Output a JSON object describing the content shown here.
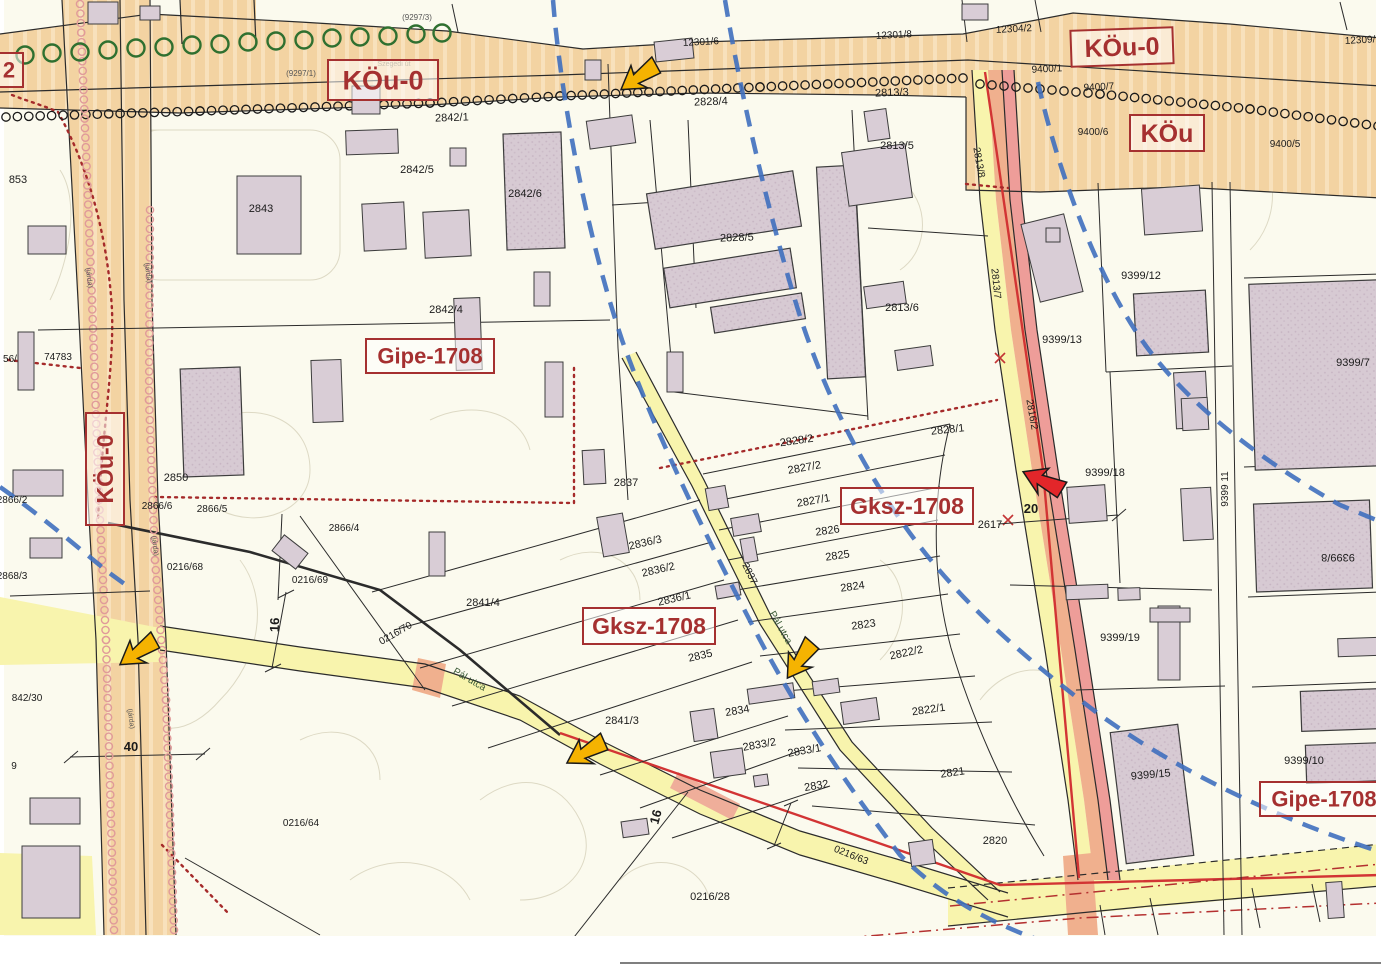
{
  "map": {
    "colors": {
      "zone_red": "#a53030",
      "road_orange": "#f3d3a2",
      "road_yellow": "#f8f4ad",
      "strip_salmon": "#f0b08e",
      "strip_pink": "#ee9d99",
      "blue_dash": "#3f6fbe",
      "arrow_yellow": "#F5B301",
      "arrow_red": "#E3262A",
      "building_fill": "#d9cdd6",
      "paper": "#fbfaee"
    },
    "zone_boxes": [
      {
        "t": "KÖu-0",
        "x": 383,
        "y": 80,
        "w": 110,
        "h": 40,
        "fs": 27
      },
      {
        "t": "KÖu-0",
        "x": 1122,
        "y": 47,
        "w": 102,
        "h": 36,
        "fs": 25,
        "rot": -2
      },
      {
        "t": "KÖu",
        "x": 1167,
        "y": 133,
        "w": 74,
        "h": 36,
        "fs": 25
      },
      {
        "t": "Gipe-1708",
        "x": 430,
        "y": 356,
        "w": 128,
        "h": 34,
        "fs": 22
      },
      {
        "t": "Gksz-1708",
        "x": 907,
        "y": 506,
        "w": 132,
        "h": 36,
        "fs": 23
      },
      {
        "t": "Gksz-1708",
        "x": 649,
        "y": 626,
        "w": 132,
        "h": 36,
        "fs": 23
      },
      {
        "t": "Gipe-1708",
        "x": 1324,
        "y": 799,
        "w": 128,
        "h": 34,
        "fs": 22
      },
      {
        "t": "KÖu-0",
        "x": 105,
        "y": 469,
        "w": 38,
        "h": 112,
        "fs": 23,
        "tr": -90
      },
      {
        "t": "2",
        "x": 9,
        "y": 70,
        "w": 28,
        "h": 34,
        "fs": 22
      }
    ],
    "labels": [
      {
        "t": "853",
        "x": 18,
        "y": 183
      },
      {
        "t": "56/",
        "x": 10,
        "y": 362,
        "s": 10
      },
      {
        "t": "74783",
        "x": 58,
        "y": 360,
        "s": 10
      },
      {
        "t": "2843",
        "x": 261,
        "y": 212
      },
      {
        "t": "2842/1",
        "x": 452,
        "y": 121,
        "r": -2
      },
      {
        "t": "2842/5",
        "x": 417,
        "y": 173
      },
      {
        "t": "2842/6",
        "x": 525,
        "y": 197
      },
      {
        "t": "2842/4",
        "x": 446,
        "y": 313
      },
      {
        "t": "2850",
        "x": 176,
        "y": 481
      },
      {
        "t": "2866/6",
        "x": 157,
        "y": 509,
        "s": 10
      },
      {
        "t": "2866/5",
        "x": 212,
        "y": 512,
        "s": 10
      },
      {
        "t": "2866/4",
        "x": 344,
        "y": 531,
        "s": 10
      },
      {
        "t": "2866/2",
        "x": 12,
        "y": 503,
        "s": 10
      },
      {
        "t": "2868/3",
        "x": 12,
        "y": 579,
        "s": 10
      },
      {
        "t": "0216/68",
        "x": 185,
        "y": 570,
        "s": 10
      },
      {
        "t": "0216/69",
        "x": 310,
        "y": 583,
        "s": 10
      },
      {
        "t": "0216/70",
        "x": 397,
        "y": 636,
        "r": -30,
        "s": 10
      },
      {
        "t": "0216/64",
        "x": 301,
        "y": 826,
        "s": 10
      },
      {
        "t": "842/30",
        "x": 27,
        "y": 701,
        "s": 10
      },
      {
        "t": "9",
        "x": 14,
        "y": 769,
        "s": 10
      },
      {
        "t": "2841/4",
        "x": 483,
        "y": 606
      },
      {
        "t": "2841/3",
        "x": 622,
        "y": 724
      },
      {
        "t": "2837",
        "x": 626,
        "y": 486
      },
      {
        "t": "2837",
        "x": 747,
        "y": 575,
        "r": 64,
        "s": 10
      },
      {
        "t": "2836/3",
        "x": 646,
        "y": 546,
        "r": -13
      },
      {
        "t": "2836/2",
        "x": 659,
        "y": 573,
        "r": -13
      },
      {
        "t": "2836/1",
        "x": 675,
        "y": 602,
        "r": -13
      },
      {
        "t": "2835",
        "x": 701,
        "y": 659,
        "r": -13
      },
      {
        "t": "2834",
        "x": 738,
        "y": 714,
        "r": -10
      },
      {
        "t": "2833/2",
        "x": 760,
        "y": 748,
        "r": -10
      },
      {
        "t": "2833/1",
        "x": 805,
        "y": 754,
        "r": -10
      },
      {
        "t": "2832",
        "x": 817,
        "y": 789,
        "r": -10
      },
      {
        "t": "2828/2",
        "x": 797,
        "y": 444,
        "r": -8
      },
      {
        "t": "2828/1",
        "x": 948,
        "y": 433,
        "r": -6
      },
      {
        "t": "2827/2",
        "x": 805,
        "y": 471,
        "r": -10
      },
      {
        "t": "2827/1",
        "x": 814,
        "y": 504,
        "r": -10
      },
      {
        "t": "2826",
        "x": 828,
        "y": 534,
        "r": -8
      },
      {
        "t": "2825",
        "x": 838,
        "y": 559,
        "r": -8
      },
      {
        "t": "2824",
        "x": 853,
        "y": 590,
        "r": -8
      },
      {
        "t": "2823",
        "x": 864,
        "y": 628,
        "r": -8
      },
      {
        "t": "2822/2",
        "x": 907,
        "y": 656,
        "r": -12
      },
      {
        "t": "2822/1",
        "x": 929,
        "y": 713,
        "r": -8
      },
      {
        "t": "2821",
        "x": 953,
        "y": 776,
        "r": -8
      },
      {
        "t": "2820",
        "x": 995,
        "y": 844
      },
      {
        "t": "2617",
        "x": 990,
        "y": 528
      },
      {
        "t": "0216/28",
        "x": 710,
        "y": 900
      },
      {
        "t": "0216/63",
        "x": 850,
        "y": 858,
        "r": 22,
        "s": 10
      },
      {
        "t": "2828/4",
        "x": 711,
        "y": 105,
        "r": -2
      },
      {
        "t": "2828/5",
        "x": 737,
        "y": 241,
        "r": -2
      },
      {
        "t": "2813/3",
        "x": 892,
        "y": 96,
        "r": -2
      },
      {
        "t": "2813/5",
        "x": 897,
        "y": 149
      },
      {
        "t": "2813/6",
        "x": 902,
        "y": 311
      },
      {
        "t": "2813/8",
        "x": 976,
        "y": 163,
        "r": 80,
        "s": 10
      },
      {
        "t": "2813/7",
        "x": 993,
        "y": 284,
        "r": 84,
        "s": 10
      },
      {
        "t": "2816/2",
        "x": 1029,
        "y": 415,
        "r": 80,
        "s": 10
      },
      {
        "t": "12301/6",
        "x": 701,
        "y": 45,
        "r": -3,
        "s": 10
      },
      {
        "t": "12301/8",
        "x": 894,
        "y": 38,
        "r": -3,
        "s": 10
      },
      {
        "t": "12304/2",
        "x": 1014,
        "y": 32,
        "r": -3,
        "s": 10
      },
      {
        "t": "12309/2",
        "x": 1363,
        "y": 43,
        "r": -3,
        "s": 10
      },
      {
        "t": "9400/1",
        "x": 1047,
        "y": 72,
        "r": -3,
        "s": 10
      },
      {
        "t": "9400/7",
        "x": 1099,
        "y": 90,
        "r": -3,
        "s": 10
      },
      {
        "t": "9400/6",
        "x": 1093,
        "y": 135,
        "s": 10
      },
      {
        "t": "9400/5",
        "x": 1285,
        "y": 147,
        "s": 10
      },
      {
        "t": "9399/12",
        "x": 1141,
        "y": 279
      },
      {
        "t": "9399/13",
        "x": 1062,
        "y": 343
      },
      {
        "t": "9399/7",
        "x": 1353,
        "y": 366
      },
      {
        "t": "9399/18",
        "x": 1105,
        "y": 476
      },
      {
        "t": "9399 11",
        "x": 1228,
        "y": 489,
        "r": -90,
        "s": 10
      },
      {
        "t": "9399/8",
        "x": 1338,
        "y": 554,
        "r": 180
      },
      {
        "t": "9399/19",
        "x": 1120,
        "y": 641
      },
      {
        "t": "9399/15",
        "x": 1151,
        "y": 778,
        "r": -5
      },
      {
        "t": "9399/10",
        "x": 1304,
        "y": 764
      },
      {
        "t": "(9297/1)",
        "x": 301,
        "y": 76,
        "s": 8,
        "c": "#555555"
      },
      {
        "t": "(9297/3)",
        "x": 417,
        "y": 20,
        "s": 8,
        "c": "#555555"
      },
      {
        "t": "Szegedi út",
        "x": 394,
        "y": 66,
        "s": 7,
        "c": "#8a7a5a"
      },
      {
        "t": "(járda)",
        "x": 87,
        "y": 278,
        "r": 83,
        "s": 7,
        "c": "#555555"
      },
      {
        "t": "(járda)",
        "x": 146,
        "y": 273,
        "r": 83,
        "s": 7,
        "c": "#555555"
      },
      {
        "t": "(járda)",
        "x": 153,
        "y": 546,
        "r": 83,
        "s": 7,
        "c": "#555555"
      },
      {
        "t": "(járda)",
        "x": 129,
        "y": 719,
        "r": 83,
        "s": 7,
        "c": "#555555"
      },
      {
        "t": "Pál utca",
        "x": 468,
        "y": 682,
        "r": 30,
        "s": 10,
        "c": "#3a5a35"
      },
      {
        "t": "Pál utca",
        "x": 778,
        "y": 629,
        "r": 60,
        "s": 10,
        "c": "#3a5a35"
      },
      {
        "t": "40",
        "x": 131,
        "y": 751,
        "s": 13,
        "b": 1
      },
      {
        "t": "16",
        "x": 279,
        "y": 625,
        "r": -88,
        "s": 13,
        "b": 1
      },
      {
        "t": "16",
        "x": 660,
        "y": 818,
        "r": -75,
        "s": 13,
        "b": 1
      },
      {
        "t": "20",
        "x": 1031,
        "y": 513,
        "s": 13,
        "b": 1
      }
    ],
    "arrows": [
      {
        "x": 639,
        "y": 77,
        "rot": -35,
        "color": "yellow"
      },
      {
        "x": 138,
        "y": 652,
        "rot": -35,
        "color": "yellow"
      },
      {
        "x": 586,
        "y": 752,
        "rot": -30,
        "color": "yellow"
      },
      {
        "x": 800,
        "y": 660,
        "rot": -55,
        "color": "yellow"
      },
      {
        "x": 1043,
        "y": 481,
        "rot": 25,
        "color": "red"
      }
    ]
  }
}
